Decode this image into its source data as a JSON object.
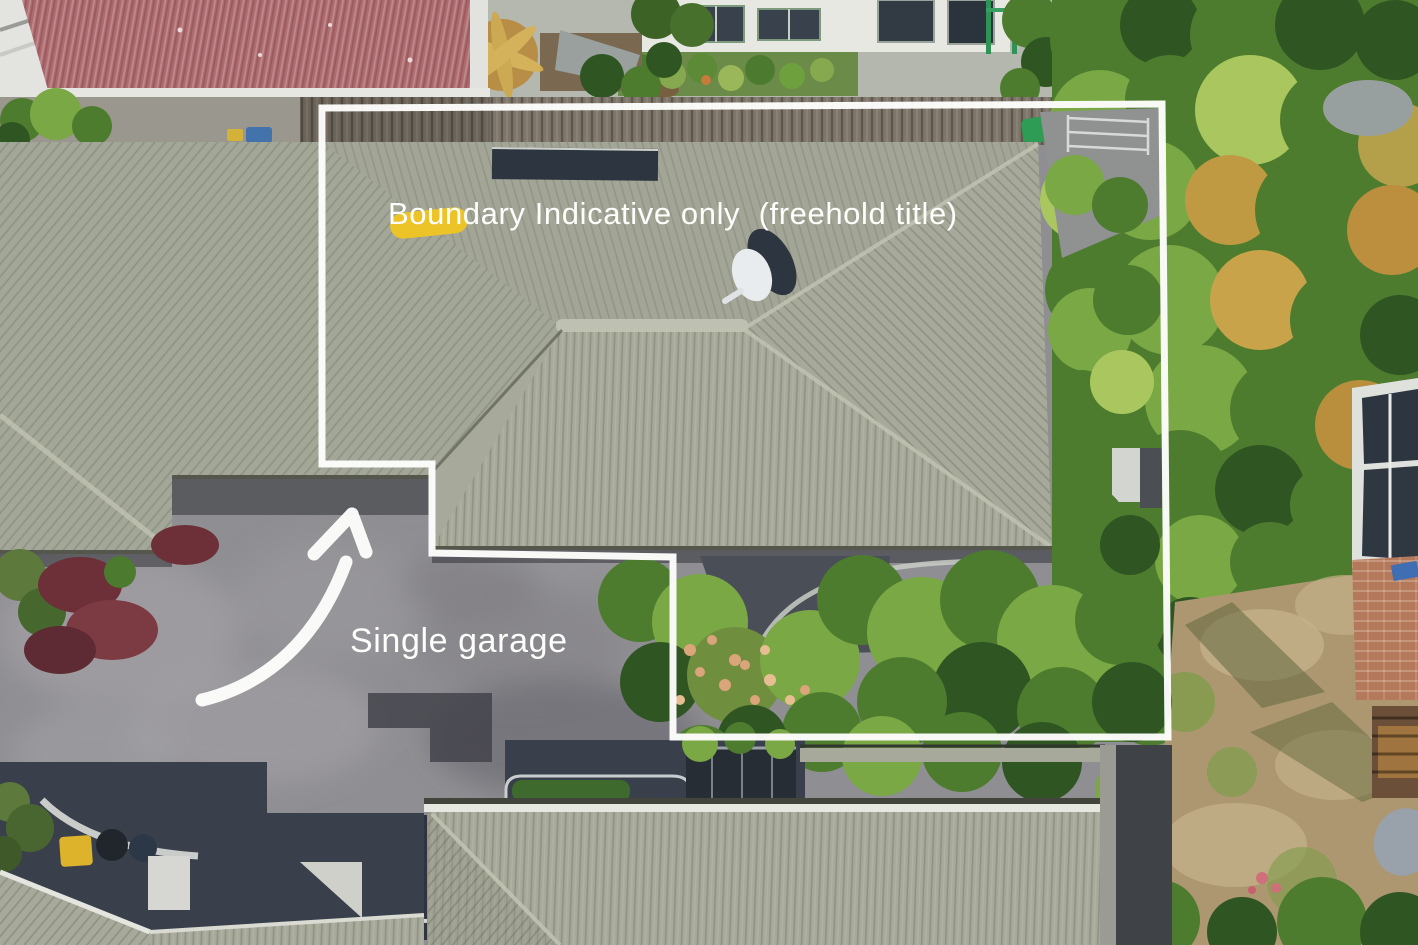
{
  "annotations": {
    "boundary_label": "Boundary Indicative only  (freehold title)",
    "garage_label": "Single garage",
    "overlay_color": "#ffffff"
  },
  "palette": {
    "white": "#fdfdfc",
    "sage": "#a7aa9a",
    "sageDark": "#979a8a",
    "sageLight": "#c0c2b2",
    "redRoof": "#ab6b6f",
    "drive": "#8f8e92",
    "driveLight": "#a7a6aa",
    "shadow": "#39404b",
    "navy": "#2c3540",
    "fence": "#7e766a",
    "tree": "#4e7c2f",
    "treeDark": "#2f5522",
    "treeLight": "#7aa844",
    "treeYellow": "#a9c75e",
    "grassDry": "#ac9770",
    "grassLight": "#c4b189",
    "brick": "#b4795b",
    "kerb": "#c9ccc6"
  },
  "scene": {
    "type": "aerial-drone-photo",
    "features": [
      "main-house-roof",
      "garage-wing-roof",
      "neighbor-red-roof",
      "driveway",
      "timber-fence",
      "satellite-dish",
      "roof-skylight",
      "backyard-trees",
      "dry-lawn",
      "brick-patio",
      "conservatory-roof",
      "pergola",
      "rear-house-roof",
      "shadowed-courtyard",
      "wheelie-bins",
      "clothesline",
      "boundary-outline",
      "garage-arrow"
    ]
  }
}
